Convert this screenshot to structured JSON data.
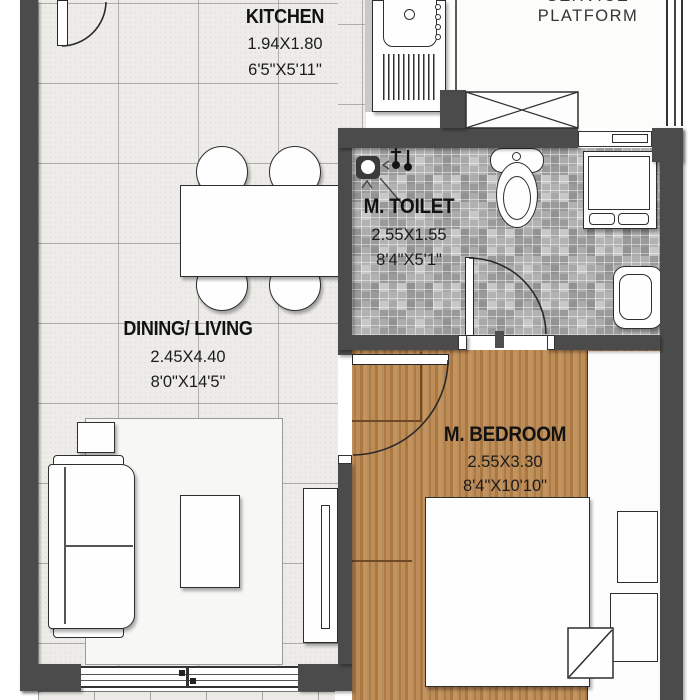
{
  "rooms": {
    "kitchen": {
      "name": "KITCHEN",
      "dim_m": "1.94X1.80",
      "dim_ft": "6'5\"X5'11\""
    },
    "dining_living": {
      "name": "DINING/ LIVING",
      "dim_m": "2.45X4.40",
      "dim_ft": "8'0\"X14'5\""
    },
    "m_toilet": {
      "name": "M. TOILET",
      "dim_m": "2.55X1.55",
      "dim_ft": "8'4\"X5'1\""
    },
    "m_bedroom": {
      "name": "M. BEDROOM",
      "dim_m": "2.55X3.30",
      "dim_ft": "8'4\"X10'10\""
    },
    "service_platform": {
      "name_top_partial": "SERVICE",
      "name": "PLATFORM"
    }
  },
  "fixtures": [
    "entrance-door",
    "kitchen-counter-sink",
    "stove-knobs",
    "drainboard",
    "dining-table",
    "dining-chair",
    "sofa",
    "side-table",
    "coffee-table",
    "rug",
    "tv-unit",
    "sliding-window",
    "shaft-cross-box",
    "platform-window",
    "wc-toilet",
    "washing-machine",
    "wash-basin",
    "shower-drain",
    "wall-taps",
    "toilet-door",
    "ventilator-window",
    "bedroom-door",
    "double-bed",
    "blanket-fold",
    "nightstand",
    "wardrobe-strip",
    "balcony-strip"
  ],
  "colors": {
    "wall": "#4b4b4b",
    "tile_floor": "#edece9",
    "wood_floor": "#b5854f",
    "mosaic_floor": "#bdbdbd",
    "fixture_outline": "#2e2e2e",
    "label_text": "#121212"
  }
}
